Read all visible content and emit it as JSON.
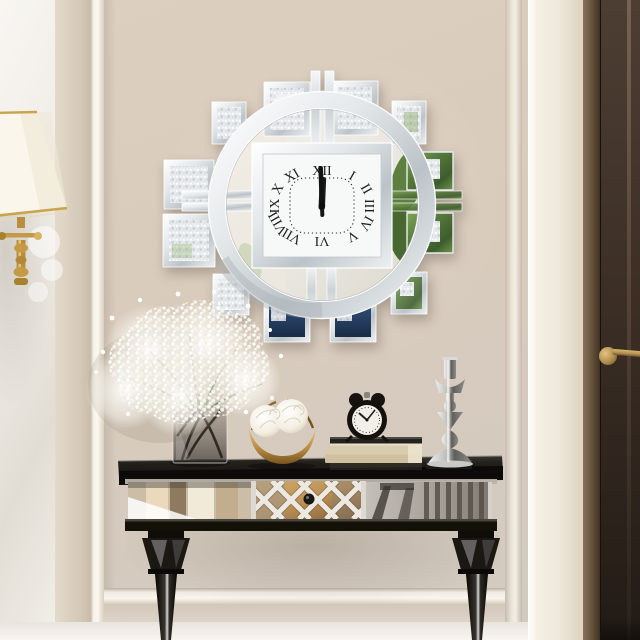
{
  "scene": {
    "type": "interior photograph",
    "description": "Cream panelled hallway with a mirrored crystal sunburst wall clock above a mirrored console table, beside a dark brown door",
    "wall_clock": {
      "style": "mirrored square face with crystal tiles and circular ring",
      "time": "12:00",
      "numerals": [
        "XII",
        "I",
        "II",
        "III",
        "IV",
        "V",
        "VI",
        "VII",
        "VIII",
        "IX",
        "X",
        "XI"
      ]
    },
    "alarm_clock": {
      "style": "black twin-bell retro alarm clock",
      "time": "10:10"
    },
    "decor_items": {
      "bouquet": "baby's breath in smoked glass cube vase",
      "bowl": "gold crescent stand with two white peonies",
      "books": "stack of three hardcover books",
      "candlestick": "silver geometric candlestick",
      "lamp": "brass lamp with white tapered shade",
      "table": "mirrored console table with lattice drawer and dark tapered legs",
      "door": "dark brown door with brass lever handle"
    }
  },
  "palette": {
    "wall_beige": "#d8cbbc",
    "wall_white": "#f4f1ea",
    "column_white": "#efe8dc",
    "door_brown": "#3c2f26",
    "door_frame_bronze": "#6b563f",
    "brass": "#b08d4f",
    "mirror_silver": "#dfe2e4",
    "dial_white": "#f7f8f8",
    "numeral_black": "#1f1f1f",
    "navy_reflection": "#26405f",
    "plant_green": "#5d8040",
    "table_black": "#1c1915",
    "gold_drawer": "#bb9055",
    "book_cream": "#d8cbae",
    "crystal_white": "#eef0f1",
    "shade_white": "#faf6ec"
  }
}
